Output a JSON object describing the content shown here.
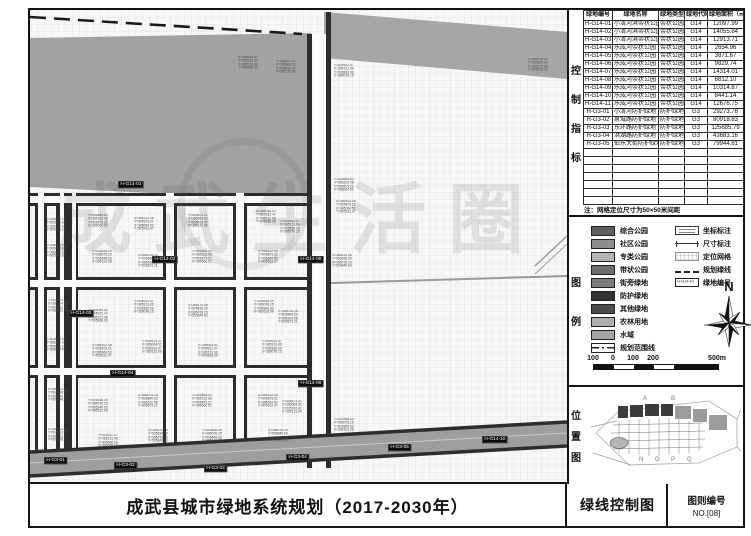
{
  "title_block": {
    "main_title": "成武县城市绿地系统规划（2017-2030年）",
    "sheet_name": "绿线控制图",
    "sheet_no_label": "图则编号",
    "sheet_no": "NO.[08]"
  },
  "section_labels": {
    "control": "控制指标",
    "legend": "图例",
    "location": "位置图"
  },
  "table": {
    "headers": [
      "绿地编号",
      "绿地名称",
      "绿地类型",
      "绿地代码",
      "绿地面积（㎡）"
    ],
    "rows": [
      [
        "H-G14-01",
        "小清河滨带状公园",
        "带状公园",
        "G14",
        "12097.99"
      ],
      [
        "H-G14-02",
        "小清河滨带状公园",
        "带状公园",
        "G14",
        "14055.84"
      ],
      [
        "H-G14-03",
        "小清河滨带状公园",
        "带状公园",
        "G14",
        "12913.71"
      ],
      [
        "H-G14-04",
        "乐成河带状公园",
        "带状公园",
        "G14",
        "2654.96"
      ],
      [
        "H-G14-05",
        "乐成河带状公园",
        "带状公园",
        "G14",
        "3871.67"
      ],
      [
        "H-G14-06",
        "乐成河带状公园",
        "带状公园",
        "G14",
        "9829.74"
      ],
      [
        "H-G14-07",
        "乐成河带状公园",
        "带状公园",
        "G14",
        "14314.01"
      ],
      [
        "H-G14-08",
        "乐成河带状公园",
        "带状公园",
        "G14",
        "6812.10"
      ],
      [
        "H-G14-09",
        "乐成河带状公园",
        "带状公园",
        "G14",
        "10314.87"
      ],
      [
        "H-G14-10",
        "乐成河带状公园",
        "带状公园",
        "G14",
        "8441.14"
      ],
      [
        "H-G14-11",
        "乐成河带状公园",
        "带状公园",
        "G14",
        "12676.75"
      ],
      [
        "H-G3-01",
        "小清河防护绿地",
        "防护绿地",
        "G3",
        "29273.78"
      ],
      [
        "H-G3-02",
        "泉城路防护绿地",
        "防护绿地",
        "G3",
        "80918.83"
      ],
      [
        "H-G3-03",
        "东环路防护绿地",
        "防护绿地",
        "G3",
        "125685.79"
      ],
      [
        "H-G3-04",
        "洪湖路防护绿地",
        "防护绿地",
        "G3",
        "43683.16"
      ],
      [
        "H-G3-05",
        "伯乐大街防护绿地",
        "防护绿地",
        "G3",
        "79944.81"
      ]
    ],
    "empty_rows": 7,
    "note": "注：网格定位尺寸为50×50米间距"
  },
  "legend": {
    "swatches": [
      {
        "label": "综合公园",
        "color": "#5f5f5f"
      },
      {
        "label": "社区公园",
        "color": "#8d8d8d"
      },
      {
        "label": "专类公园",
        "color": "#b5b5b5"
      },
      {
        "label": "带状公园",
        "color": "#6e6e6e"
      },
      {
        "label": "街旁绿地",
        "color": "#7e7e7e"
      },
      {
        "label": "防护绿地",
        "color": "#353535"
      },
      {
        "label": "其他绿地",
        "color": "#4d4d4d"
      },
      {
        "label": "农林用地",
        "color": "#aeaeae"
      },
      {
        "label": "水域",
        "color": "#a6a6a6"
      },
      {
        "label": "规划范围线",
        "color": "dashdot"
      }
    ],
    "symbols": [
      {
        "label": "坐标标注",
        "type": "coord"
      },
      {
        "label": "尺寸标注",
        "type": "dim"
      },
      {
        "label": "定位网格",
        "type": "grid"
      },
      {
        "label": "规划绿线",
        "type": "gdash"
      },
      {
        "label": "绿地编号",
        "type": "idbox"
      }
    ],
    "id_box_sample": "H-G14-01",
    "north_label": "N",
    "scale_labels": [
      "100",
      "0",
      "100",
      "200",
      "500m"
    ]
  },
  "location_map": {
    "letters_top": [
      "A",
      "B"
    ],
    "letters_bottom": [
      "N",
      "O",
      "P",
      "Q"
    ]
  },
  "map": {
    "watermark": "成武生活圈",
    "badges": [
      {
        "id": "H-G14-01",
        "x": 88,
        "y": 171
      },
      {
        "id": "H-G14-02",
        "x": 122,
        "y": 246
      },
      {
        "id": "H-G14-03",
        "x": 38,
        "y": 300
      },
      {
        "id": "H-G14-04",
        "x": 80,
        "y": 360
      },
      {
        "id": "H-G14-08",
        "x": 268,
        "y": 246
      },
      {
        "id": "H-G14-09",
        "x": 268,
        "y": 370
      },
      {
        "id": "H-G3-01",
        "x": 14,
        "y": 447
      },
      {
        "id": "H-G3-02",
        "x": 84,
        "y": 452
      },
      {
        "id": "H-G3-03",
        "x": 174,
        "y": 455
      },
      {
        "id": "H-G3-04",
        "x": 256,
        "y": 444
      },
      {
        "id": "H-G3-05",
        "x": 358,
        "y": 434
      },
      {
        "id": "H-G14-10",
        "x": 452,
        "y": 426
      }
    ],
    "coord_samples": [
      "X=385076.15",
      "Y=505849.63",
      "X=385102.08",
      "Y=505873.21",
      "X=385064.52",
      "Y=505912.47",
      "X=385131.96",
      "Y=505836.09"
    ]
  }
}
